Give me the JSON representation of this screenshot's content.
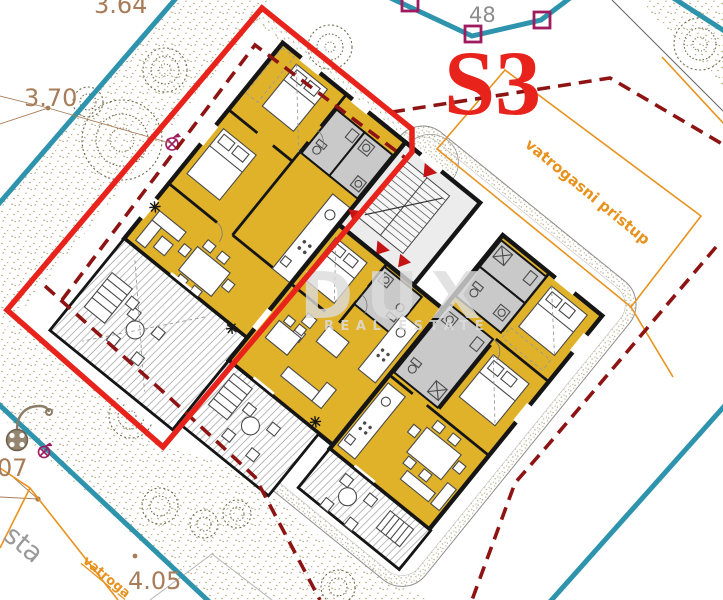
{
  "plan": {
    "unit_label": "S3",
    "parcel_number": "48",
    "elevations": {
      "e1": "3.64",
      "e2": "3.70",
      "e3": "4.05",
      "e4": "07"
    },
    "road_label_partial": "sta",
    "fire_access_label": "vatrogasni pristup",
    "fire_access_label_partial": "vatroga",
    "colors": {
      "selected_unit_outline": "#e8231c",
      "setback_dashed": "#8e1414",
      "parcel_boundary": "#2e93ac",
      "fire_lane": "#e8921e",
      "survey_marker": "#9e1b60",
      "apartment_floor": "#e0b22a",
      "elevation_text": "#a87c58"
    }
  },
  "watermark": {
    "brand": "DUX",
    "tagline": "REAL ESTATE"
  }
}
